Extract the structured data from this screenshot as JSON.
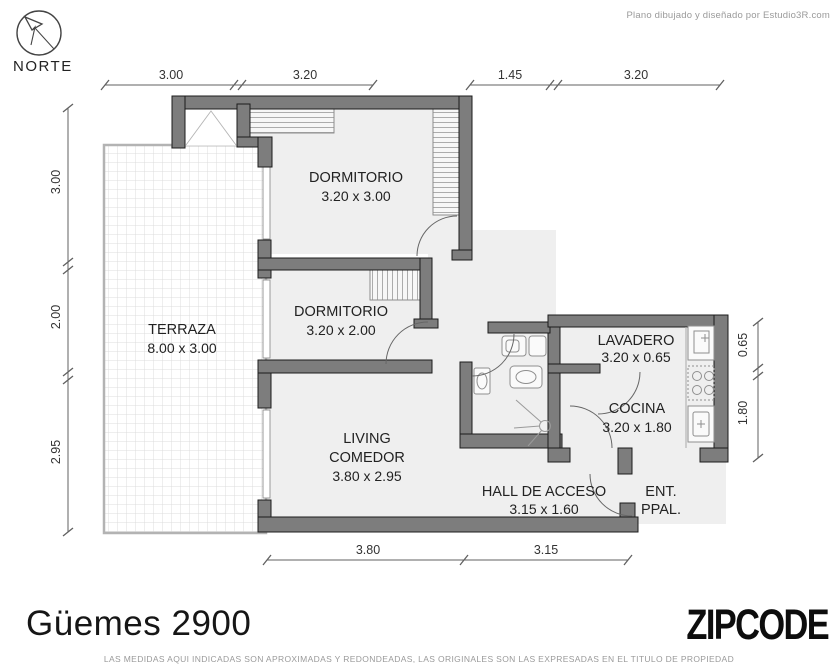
{
  "header": {
    "credit": "Plano dibujado y diseñado por Estudio3R.com"
  },
  "compass": {
    "label": "NORTE",
    "icon": "compass-north-arrow"
  },
  "rooms": {
    "dormitorio1": {
      "name": "DORMITORIO",
      "size": "3.20 x 3.00"
    },
    "dormitorio2": {
      "name": "DORMITORIO",
      "size": "3.20 x 2.00"
    },
    "terraza": {
      "name": "TERRAZA",
      "size": "8.00 x 3.00"
    },
    "living": {
      "line1": "LIVING",
      "line2": "COMEDOR",
      "size": "3.80 x 2.95"
    },
    "lavadero": {
      "name": "LAVADERO",
      "size": "3.20 x 0.65"
    },
    "cocina": {
      "name": "COCINA",
      "size": "3.20 x 1.80"
    },
    "hall": {
      "name": "HALL DE ACCESO",
      "size": "3.15 x 1.60"
    },
    "entrada": {
      "line1": "ENT.",
      "line2": "PPAL."
    }
  },
  "dimensions": {
    "top": [
      "3.00",
      "3.20",
      "1.45",
      "3.20"
    ],
    "left": [
      "3.00",
      "2.00",
      "2.95"
    ],
    "right": [
      "0.65",
      "1.80"
    ],
    "bottom": [
      "3.80",
      "3.15"
    ]
  },
  "footer": {
    "title": "Güemes 2900",
    "logo": "ZIPCODE",
    "disclaimer": "LAS MEDIDAS AQUI INDICADAS SON APROXIMADAS Y REDONDEADAS, LAS ORIGINALES SON LAS EXPRESADAS EN EL TITULO DE PROPIEDAD"
  },
  "palette": {
    "wall_gray": "#7d7d7d",
    "floor_gray": "#efefef",
    "line_gray": "#555555",
    "logo_black": "#0d0d0d"
  }
}
